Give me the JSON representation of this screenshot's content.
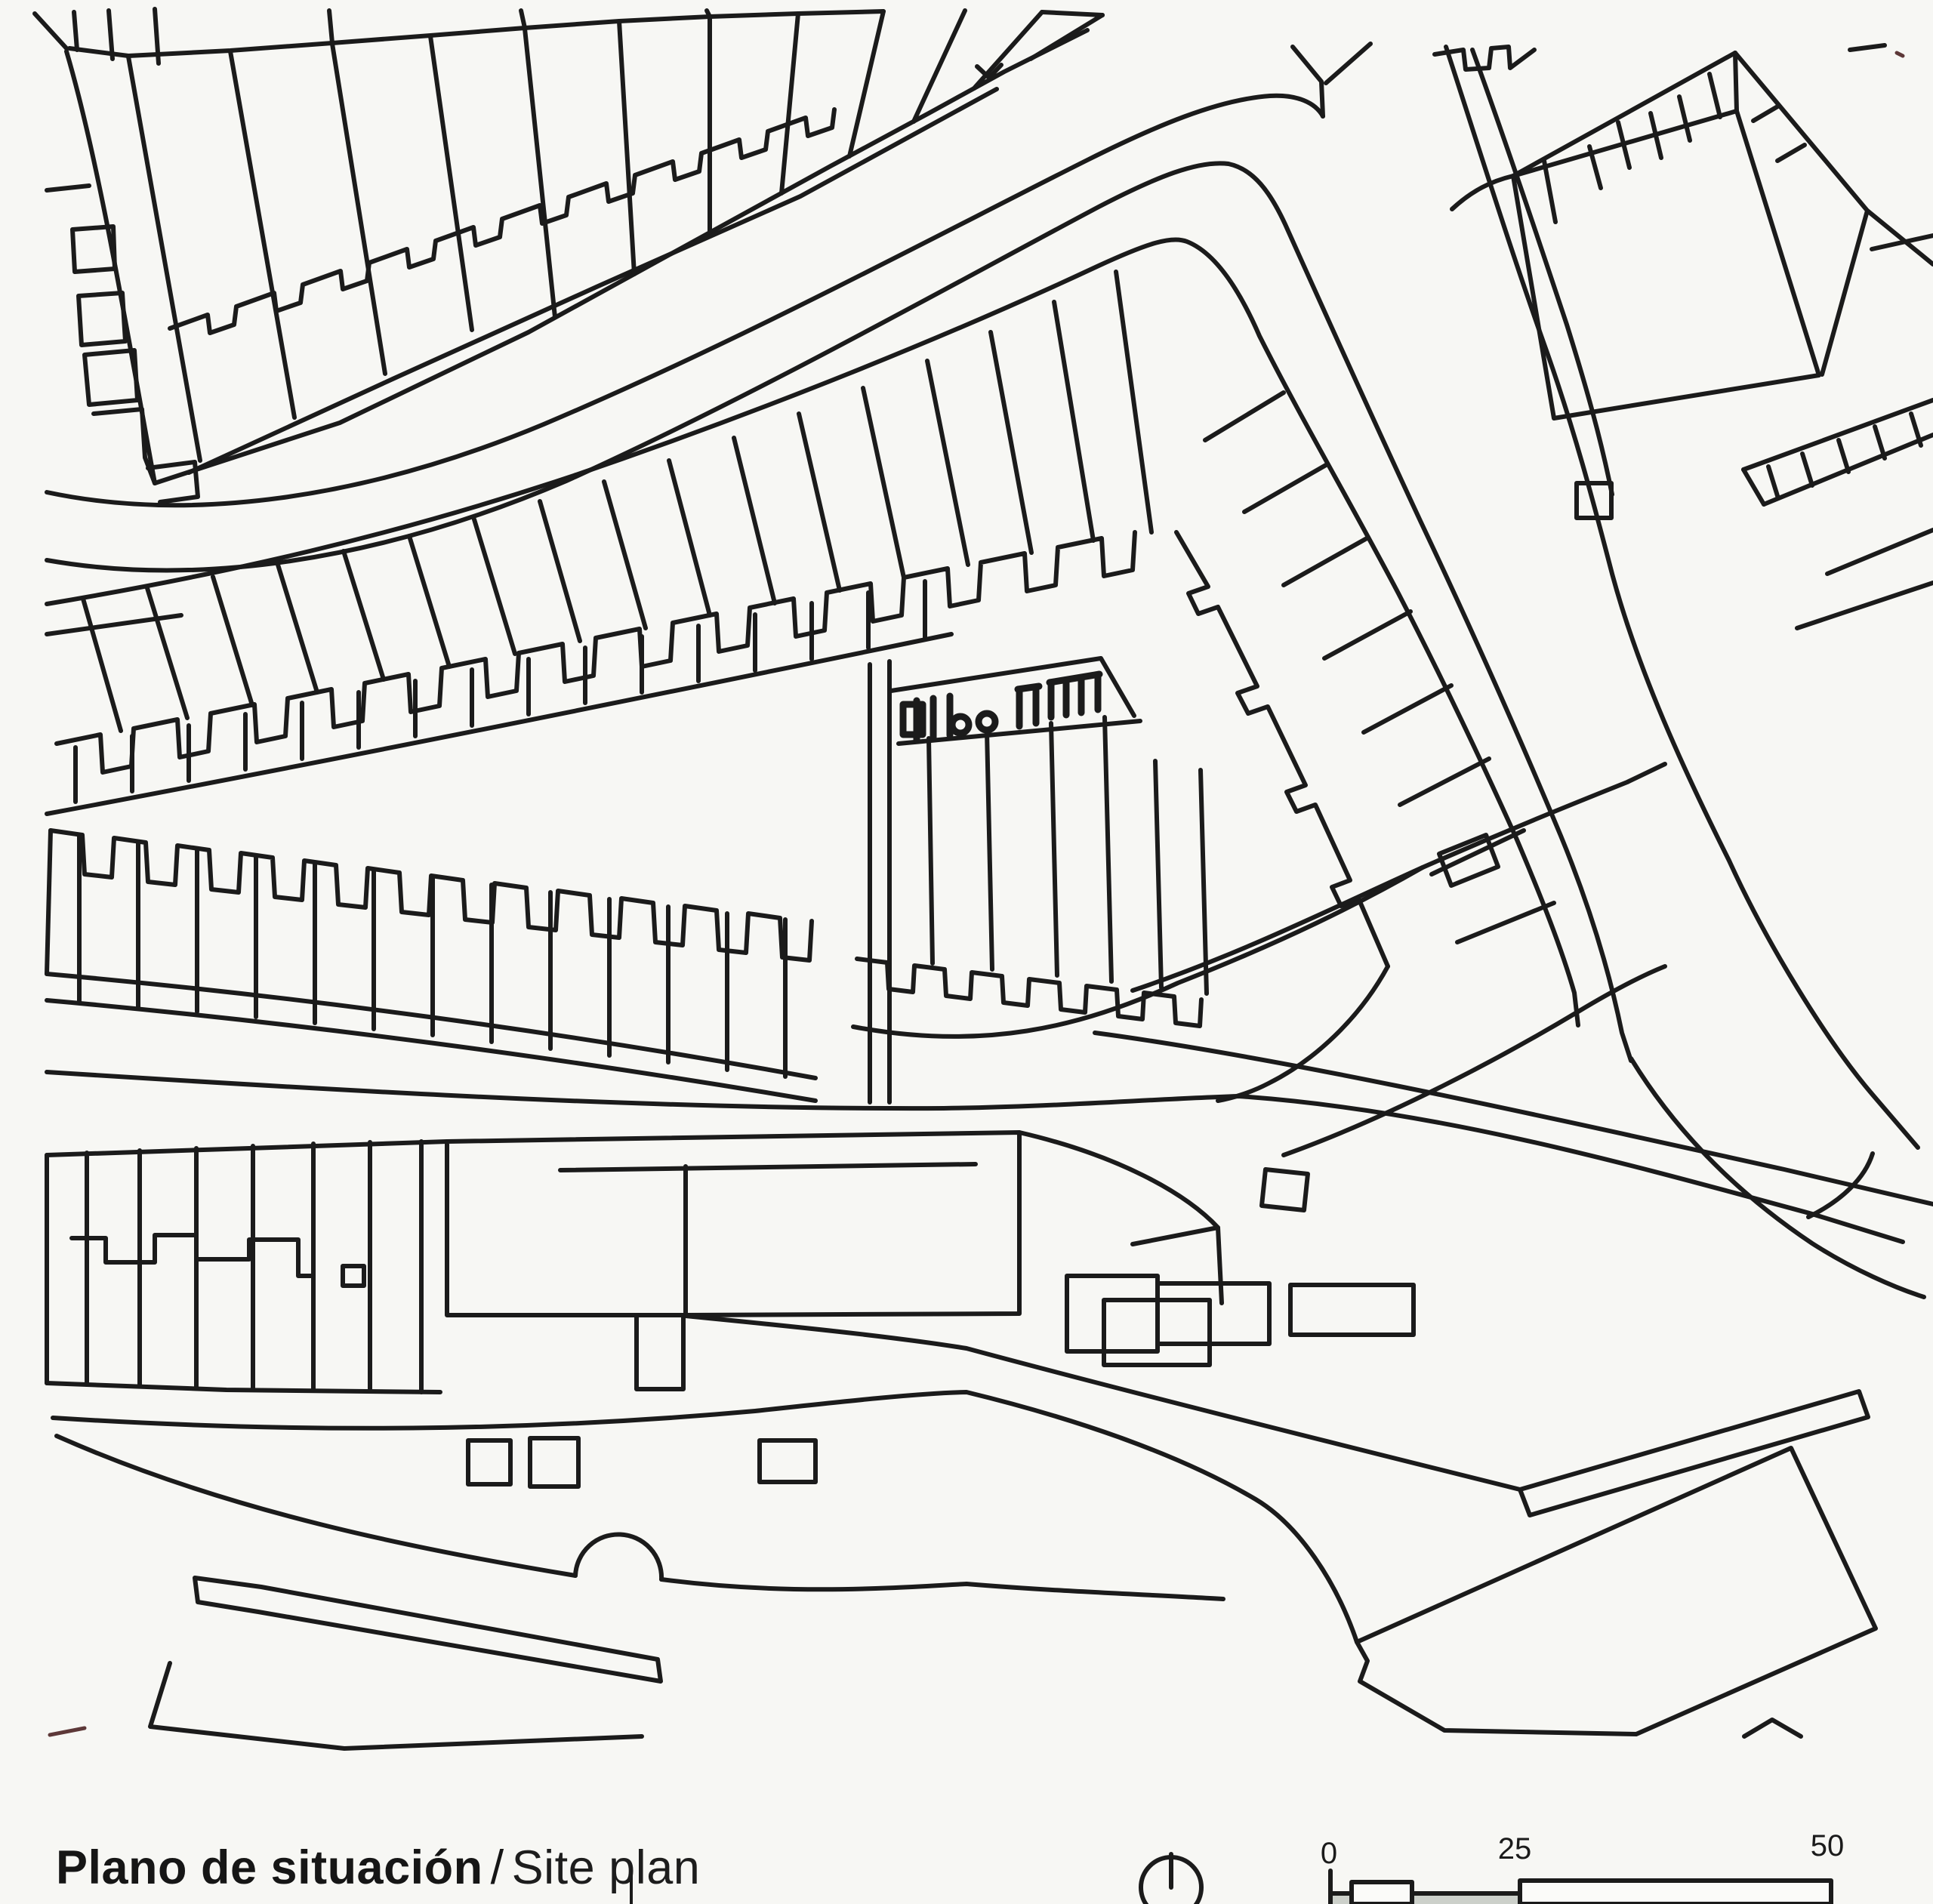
{
  "page": {
    "kind": "architectural site plan (scanned line drawing)",
    "caption": {
      "primary": "Plano de situación",
      "separator": "/",
      "secondary": "Site plan"
    }
  },
  "north": {
    "icon": "north-arrow-icon"
  },
  "scale_bar": {
    "labels": [
      "0",
      "25",
      "50"
    ]
  },
  "colors": {
    "paper": "#f7f7f4",
    "ink": "#1b1b1b",
    "scale_strip": "#ccd0ca"
  },
  "drawing": {
    "features": [
      "terraced housing block top-left",
      "curved street",
      "long terraced band with sawtooth building line",
      "corner block wrapping diagonal street",
      "project site block with building detail",
      "lower terraced band",
      "wide street band with large building",
      "diagonal building bottom-right",
      "pier / shore lines bottom-left"
    ]
  }
}
